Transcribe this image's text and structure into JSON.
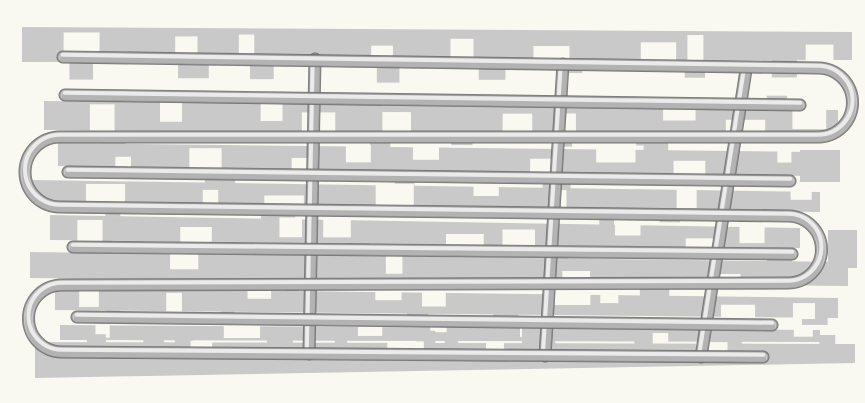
{
  "scene": {
    "type": "3d_render",
    "subject": "serpentine-pipe-coil-layout-over-notched-slab",
    "canvas": {
      "width": 865,
      "height": 403,
      "background": "#FAF9F1"
    },
    "colors": {
      "background": "#FAF9F1",
      "slab": "#C9C9C9",
      "pipe_crevice": "#606060",
      "pipe_rim": "#8F8F8F",
      "pipe_body": "#C6C6C6",
      "pipe_lower_shade": "#B0B0B0",
      "pipe_highlight": "#EDEDED"
    },
    "pipes": {
      "diameter": 12,
      "circuit_path": "M63,57 L818,68 A34.5 34.5 0 0 1 818,137 L60,137 A35 35 0 0 0 60,207 L788,216 A33.5 33.5 0 0 1 788,283 L62,285 A33.5 33.5 0 0 0 62,352 L763,357",
      "stub_rows": [
        [
          65,
          95,
          800,
          105
        ],
        [
          68,
          172,
          790,
          181
        ],
        [
          73,
          247,
          792,
          254
        ],
        [
          77,
          317,
          772,
          325
        ]
      ],
      "vertical_pipes": [
        [
          315,
          59,
          309,
          354
        ],
        [
          563,
          64,
          545,
          356
        ],
        [
          746,
          70,
          701,
          357
        ]
      ],
      "layers": [
        {
          "w": 13.0,
          "color_key": "pipe_crevice",
          "off": "none",
          "opacity": 0.85
        },
        {
          "w": 11.6,
          "color_key": "pipe_rim",
          "off": "none",
          "opacity": 1
        },
        {
          "w": 9.4,
          "color_key": "pipe_body",
          "off": "none",
          "opacity": 1
        },
        {
          "w": 6.2,
          "color_key": "pipe_lower_shade",
          "off": "shade",
          "opacity": 0.9
        },
        {
          "w": 4.0,
          "color_key": "pipe_highlight",
          "off": "light",
          "opacity": 0.95
        }
      ],
      "highlight_offset": 2.2,
      "shade_offset": 1.7
    },
    "slab": {
      "seed": 11,
      "bands": [
        {
          "x0": 22,
          "x1": 852,
          "t0": 27,
          "t1": 32,
          "b0": 62,
          "b1": 60,
          "nf": 1.1,
          "tf": 1.0,
          "th": [
            10,
            26
          ],
          "bias": "down"
        },
        {
          "x0": 44,
          "x1": 838,
          "t0": 101,
          "t1": 110,
          "b0": 130,
          "b1": 136,
          "nf": 1.3,
          "tf": 0.9,
          "th": [
            8,
            16
          ],
          "bias": "both"
        },
        {
          "x0": 58,
          "x1": 812,
          "t0": 143,
          "t1": 152,
          "b0": 166,
          "b1": 176,
          "nf": 1.2,
          "tf": 0.8,
          "th": [
            8,
            16
          ],
          "bias": "both"
        },
        {
          "x0": 33,
          "x1": 820,
          "t0": 180,
          "t1": 192,
          "b0": 203,
          "b1": 212,
          "nf": 1.0,
          "tf": 0.9,
          "th": [
            8,
            16
          ],
          "bias": "both"
        },
        {
          "x0": 50,
          "x1": 800,
          "t0": 215,
          "t1": 228,
          "b0": 240,
          "b1": 248,
          "nf": 1.2,
          "tf": 0.8,
          "th": [
            8,
            16
          ],
          "bias": "both"
        },
        {
          "x0": 30,
          "x1": 848,
          "t0": 252,
          "t1": 262,
          "b0": 278,
          "b1": 286,
          "nf": 0.45,
          "tf": 0.5,
          "th": [
            8,
            14
          ],
          "bias": "both"
        },
        {
          "x0": 55,
          "x1": 838,
          "t0": 288,
          "t1": 298,
          "b0": 310,
          "b1": 318,
          "nf": 1.1,
          "tf": 0.8,
          "th": [
            8,
            16
          ],
          "bias": "both"
        },
        {
          "x0": 60,
          "x1": 820,
          "t0": 325,
          "t1": 330,
          "b0": 340,
          "b1": 342,
          "nf": 0.9,
          "tf": 0.7,
          "th": [
            8,
            14
          ],
          "bias": "both"
        },
        {
          "x0": 35,
          "x1": 855,
          "t0": 342,
          "t1": 344,
          "b0": 378,
          "b1": 363,
          "nf": 0.5,
          "tf": 1.1,
          "th": [
            8,
            20
          ],
          "bias": "up"
        }
      ],
      "patches": [
        {
          "x": 800,
          "y": 150,
          "w": 40,
          "h": 32
        },
        {
          "x": 828,
          "y": 230,
          "w": 29,
          "h": 38
        }
      ]
    }
  }
}
